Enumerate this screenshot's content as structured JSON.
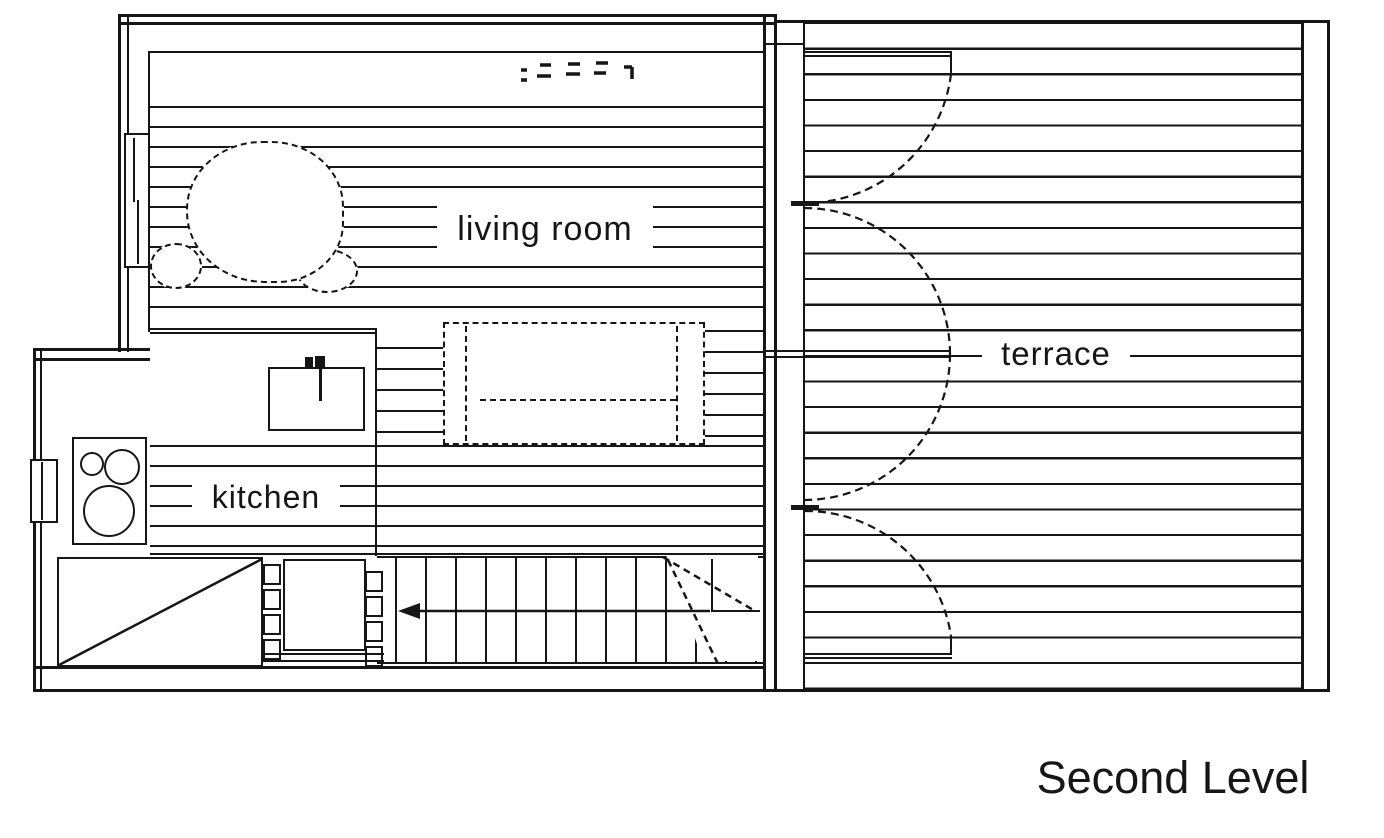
{
  "title": {
    "text": "Second Level"
  },
  "rooms": {
    "living_room": {
      "label": "living room"
    },
    "kitchen": {
      "label": "kitchen"
    },
    "terrace": {
      "label": "terrace"
    }
  },
  "colors": {
    "line": "#161616",
    "background": "#ffffff"
  },
  "fixtures": [
    "sink-with-faucet",
    "cooktop-three-burners",
    "dashed-armchair",
    "dashed-dining-table",
    "staircase-with-direction-arrow",
    "terrace-door-swings",
    "left-wall-window",
    "kitchen-bump-out-window",
    "sloped-void-diagonal"
  ],
  "annotation": {
    "name": "illegible-dashed-marks",
    "count": 5
  }
}
